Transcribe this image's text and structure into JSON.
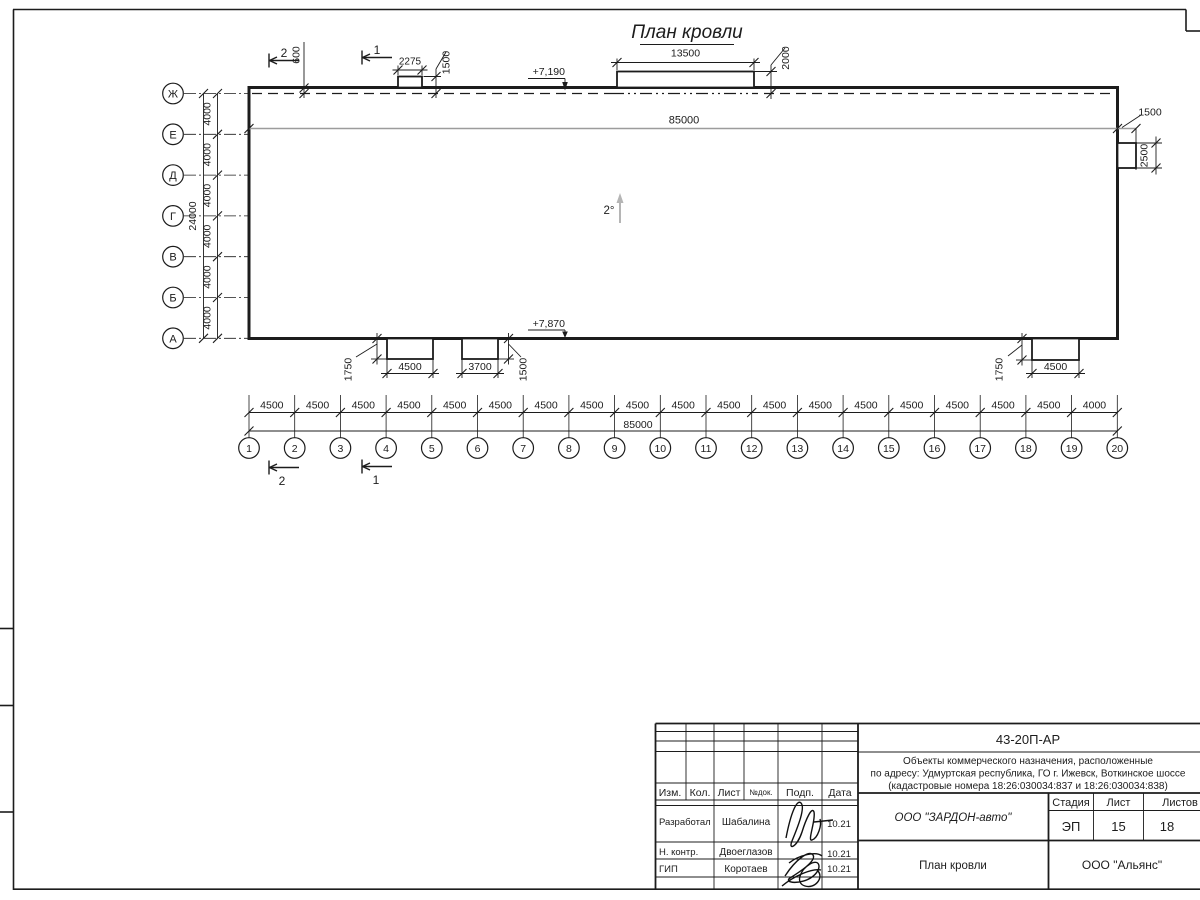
{
  "drawing": {
    "title": "План кровли",
    "slope": "2°",
    "elev_top": "+7,190",
    "elev_bottom": "+7,870",
    "inner_length": "85000",
    "total_length": "85000",
    "total_depth": "24000",
    "parapet_offset": "600",
    "section_1": "1",
    "section_2": "2",
    "top_small_w": "2275",
    "top_small_h": "1500",
    "top_large_w": "13500",
    "top_large_h": "2000",
    "right_box_w": "1500",
    "right_box_h": "2500",
    "bottom_box1_w": "4500",
    "bottom_box1_h": "1750",
    "bottom_box2_w": "3700",
    "bottom_box2_h": "1500",
    "bottom_box3_w": "4500",
    "bottom_box3_h": "1750",
    "row_axes": [
      "Ж",
      "Е",
      "Д",
      "Г",
      "В",
      "Б",
      "А"
    ],
    "row_steps": [
      "4000",
      "4000",
      "4000",
      "4000",
      "4000",
      "4000"
    ],
    "col_axes": [
      "1",
      "2",
      "3",
      "4",
      "5",
      "6",
      "7",
      "8",
      "9",
      "10",
      "11",
      "12",
      "13",
      "14",
      "15",
      "16",
      "17",
      "18",
      "19",
      "20"
    ],
    "col_steps": [
      "4500",
      "4500",
      "4500",
      "4500",
      "4500",
      "4500",
      "4500",
      "4500",
      "4500",
      "4500",
      "4500",
      "4500",
      "4500",
      "4500",
      "4500",
      "4500",
      "4500",
      "4500",
      "4000"
    ]
  },
  "titleblock": {
    "doc_number": "43-20П-АР",
    "description_line1": "Объекты коммерческого назначения, расположенные",
    "description_line2": "по адресу: Удмуртская республика, ГО г. Ижевск, Воткинское шоссе",
    "description_line3": "(кадастровые номера 18:26:030034:837 и 18:26:030034:838)",
    "col_izm": "Изм.",
    "col_kol": "Кол.",
    "col_list": "Лист",
    "col_ndok": "№док.",
    "col_podp": "Подп.",
    "col_data": "Дата",
    "role1": "Разработал",
    "name1": "Шабалина",
    "date1": "10.21",
    "role2": "Н. контр.",
    "name2": "Двоеглазов",
    "date2": "10.21",
    "role3": "ГИП",
    "name3": "Коротаев",
    "date3": "10.21",
    "company": "ООО \"ЗАРДОН-авто\"",
    "stage_label": "Стадия",
    "sheet_label": "Лист",
    "sheets_label": "Листов",
    "stage": "ЭП",
    "sheet": "15",
    "sheets": "18",
    "sheet_title": "План кровли",
    "contractor": "ООО \"Альянс\""
  }
}
